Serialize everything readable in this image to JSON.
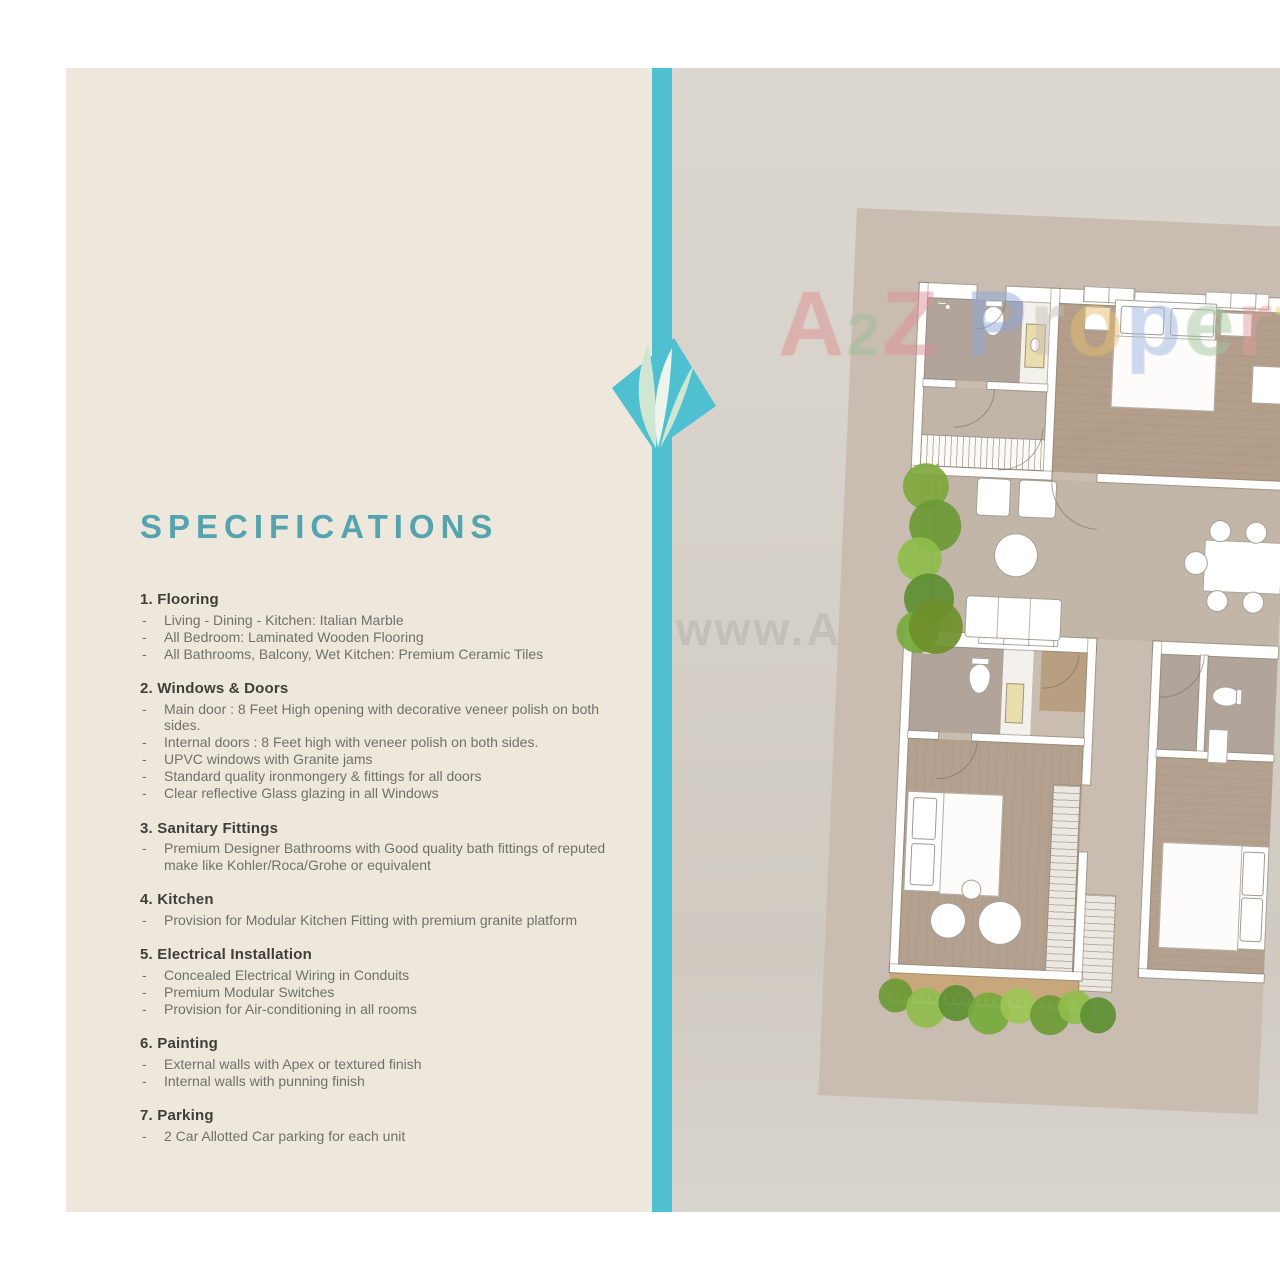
{
  "page": {
    "title": "SPECIFICATIONS",
    "bullet": "-",
    "sections": [
      {
        "heading": "1. Flooring",
        "items": [
          "Living - Dining - Kitchen: Italian Marble",
          "All Bedroom: Laminated Wooden Flooring",
          "All Bathrooms, Balcony, Wet Kitchen: Premium Ceramic Tiles"
        ]
      },
      {
        "heading": "2. Windows & Doors",
        "items": [
          "Main door : 8 Feet High opening with decorative veneer polish on both sides.",
          "Internal doors : 8 Feet high with veneer polish on both sides.",
          "UPVC windows with Granite jams",
          "Standard quality ironmongery & fittings for all doors",
          "Clear reflective Glass glazing in all Windows"
        ]
      },
      {
        "heading": "3. Sanitary Fittings",
        "items": [
          "Premium Designer Bathrooms with Good quality bath fittings of reputed make like Kohler/Roca/Grohe or equivalent"
        ]
      },
      {
        "heading": "4. Kitchen",
        "items": [
          "Provision for Modular Kitchen Fitting with premium granite platform"
        ]
      },
      {
        "heading": "5. Electrical Installation",
        "items": [
          "Concealed Electrical Wiring in Conduits",
          "Premium Modular Switches",
          "Provision for Air-conditioning in all rooms"
        ]
      },
      {
        "heading": "6. Painting",
        "items": [
          "External walls with Apex or textured finish",
          "Internal walls with punning finish"
        ]
      },
      {
        "heading": "7. Parking",
        "items": [
          "2 Car Allotted Car parking for each unit"
        ]
      }
    ]
  },
  "watermark": {
    "brand": "A2Z Property",
    "url": "www.A2ZProperty.in",
    "brand_letters": [
      {
        "ch": "A",
        "color": "#DD8F90"
      },
      {
        "ch": "2",
        "color": "#9FBE98"
      },
      {
        "ch": "Z",
        "color": "#DE8F9B"
      },
      {
        "ch": "P",
        "color": "#8FA9DC"
      },
      {
        "ch": "r",
        "color": "#C8C0B6"
      },
      {
        "ch": "o",
        "color": "#E7BE6E"
      },
      {
        "ch": "p",
        "color": "#9FB4E2"
      },
      {
        "ch": "e",
        "color": "#A4C79E"
      },
      {
        "ch": "r",
        "color": "#DE9E9E"
      },
      {
        "ch": "t",
        "color": "#EBD37E"
      },
      {
        "ch": "y",
        "color": "#9FC7A5"
      }
    ]
  },
  "colors": {
    "accent_teal": "#4EC0D0",
    "title_teal": "#55A3AE",
    "panel_cream": "#EDE8DB",
    "panel_gray": "#D5D0C8",
    "plan_background": "#C8BDB0",
    "bedroom_floor": "#B29E8B",
    "bathroom_floor": "#B1A49A",
    "balcony_floor": "#C8A77D",
    "tree_green": "#76A93B",
    "heading_text": "#3F3E39",
    "body_text": "#70706A"
  },
  "floor_plan": {
    "fixtures": [
      "toilet-icon",
      "sink-icon",
      "shower-icon",
      "vanity-counter",
      "bed",
      "pillow",
      "nightstand",
      "wardrobe",
      "stairs",
      "sofa",
      "armchair",
      "coffee-table",
      "dining-table",
      "dining-chair",
      "balcony-railing",
      "tree-icon",
      "window",
      "door-arc-icon"
    ]
  }
}
